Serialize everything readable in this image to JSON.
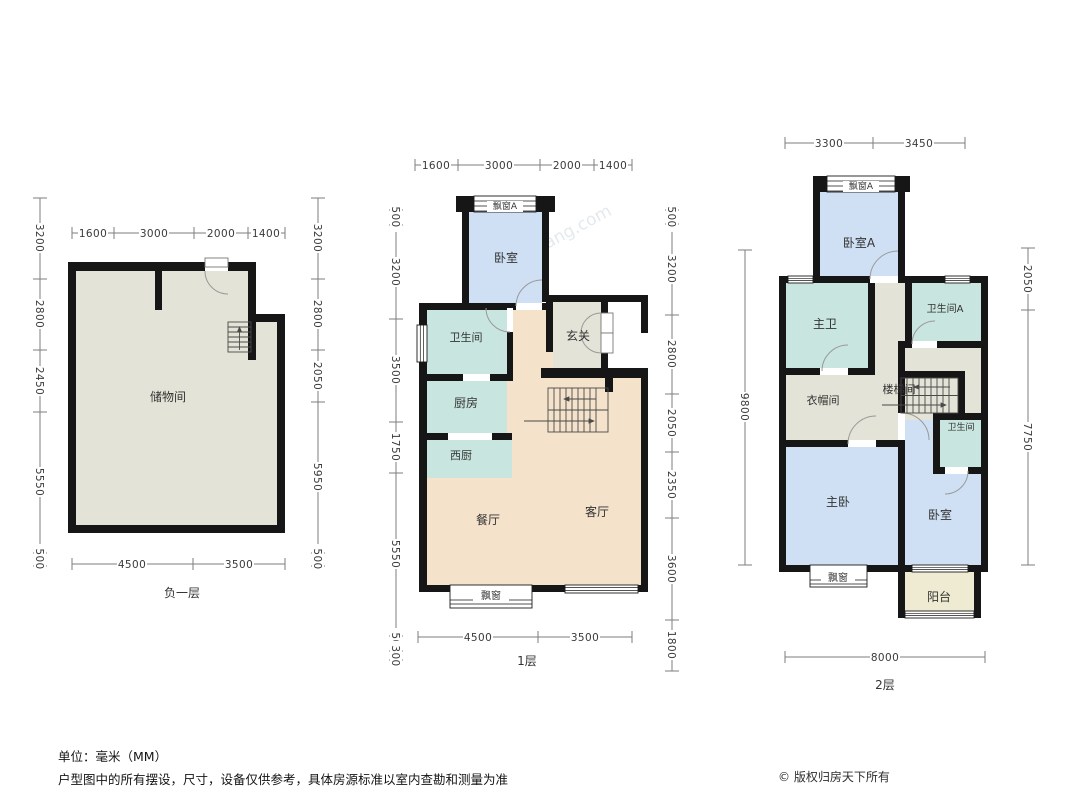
{
  "meta": {
    "watermark": "房天下fang.com"
  },
  "colors": {
    "wall": "#161616",
    "bedroom_fill": "#cfe0f4",
    "wet_room_fill": "#c8e6df",
    "hall_fill": "#f4e2cb",
    "neutral_fill": "#e3e3d7",
    "balcony_fill": "#efebd2"
  },
  "footer": {
    "unit": "单位：毫米（MM）",
    "disclaimer": "户型图中的所有摆设，尺寸，设备仅供参考，具体房源标准以室内查勘和测量为准",
    "copyright": "© 版权归房天下所有"
  },
  "plans": {
    "basement": {
      "floor_label": "负一层",
      "rooms": {
        "storage": "储物间"
      },
      "dims": {
        "top": [
          "1600",
          "3000",
          "2000",
          "1400"
        ],
        "bottom": [
          "4500",
          "3500"
        ],
        "left": [
          "3200",
          "2800",
          "2450",
          "5550",
          "500"
        ],
        "right": [
          "3200",
          "2800",
          "2050",
          "5950",
          "500"
        ]
      }
    },
    "floor1": {
      "floor_label": "1层",
      "rooms": {
        "bay_a": "飘窗A",
        "bedroom": "卧室",
        "bath": "卫生间",
        "foyer": "玄关",
        "kitchen": "厨房",
        "west_kitchen": "西厨",
        "dining": "餐厅",
        "living": "客厅",
        "bay": "飘窗"
      },
      "dims": {
        "top": [
          "1600",
          "3000",
          "2000",
          "1400"
        ],
        "bottom": [
          "4500",
          "3500"
        ],
        "left": [
          "500",
          "3200",
          "3500",
          "1750",
          "5550",
          "500",
          "300"
        ],
        "right": [
          "500",
          "3200",
          "2800",
          "2050",
          "2350",
          "3600",
          "1800"
        ]
      }
    },
    "floor2": {
      "floor_label": "2层",
      "rooms": {
        "bay_a": "飘窗A",
        "bedroom_a": "卧室A",
        "master_bath": "主卫",
        "bath_a": "卫生间A",
        "cloakroom": "衣帽间",
        "stairwell": "楼梯间",
        "bath": "卫生间",
        "master_bedroom": "主卧",
        "bedroom": "卧室",
        "balcony": "阳台",
        "bay": "飘窗"
      },
      "dims": {
        "top": [
          "3300",
          "3450"
        ],
        "bottom": [
          "8000"
        ],
        "left": [
          "9800"
        ],
        "right": [
          "2050",
          "7750"
        ]
      }
    }
  }
}
